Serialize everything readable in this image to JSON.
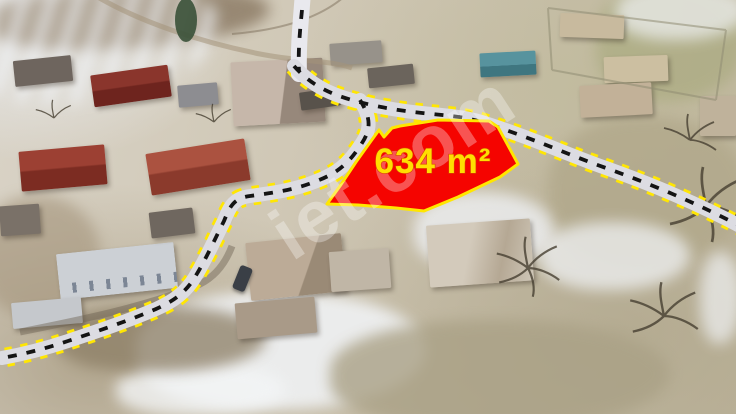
{
  "scene": {
    "type": "aerial drone photo of a village land parcel listing",
    "parcel": {
      "area_label": "634 m²",
      "fill_color": "#f50400",
      "border_color": "#ffe600",
      "label_color": "#ffdf00",
      "label_outline_color": "#d84300"
    },
    "road": {
      "surface_color": "#dcdce2",
      "top_surface_color": "#e9e9ee",
      "centerline_color": "#141414",
      "edge_dash_color": "#ffe603"
    },
    "watermark": {
      "text": "iet.com",
      "color": "rgba(255,255,255,0.32)"
    }
  }
}
